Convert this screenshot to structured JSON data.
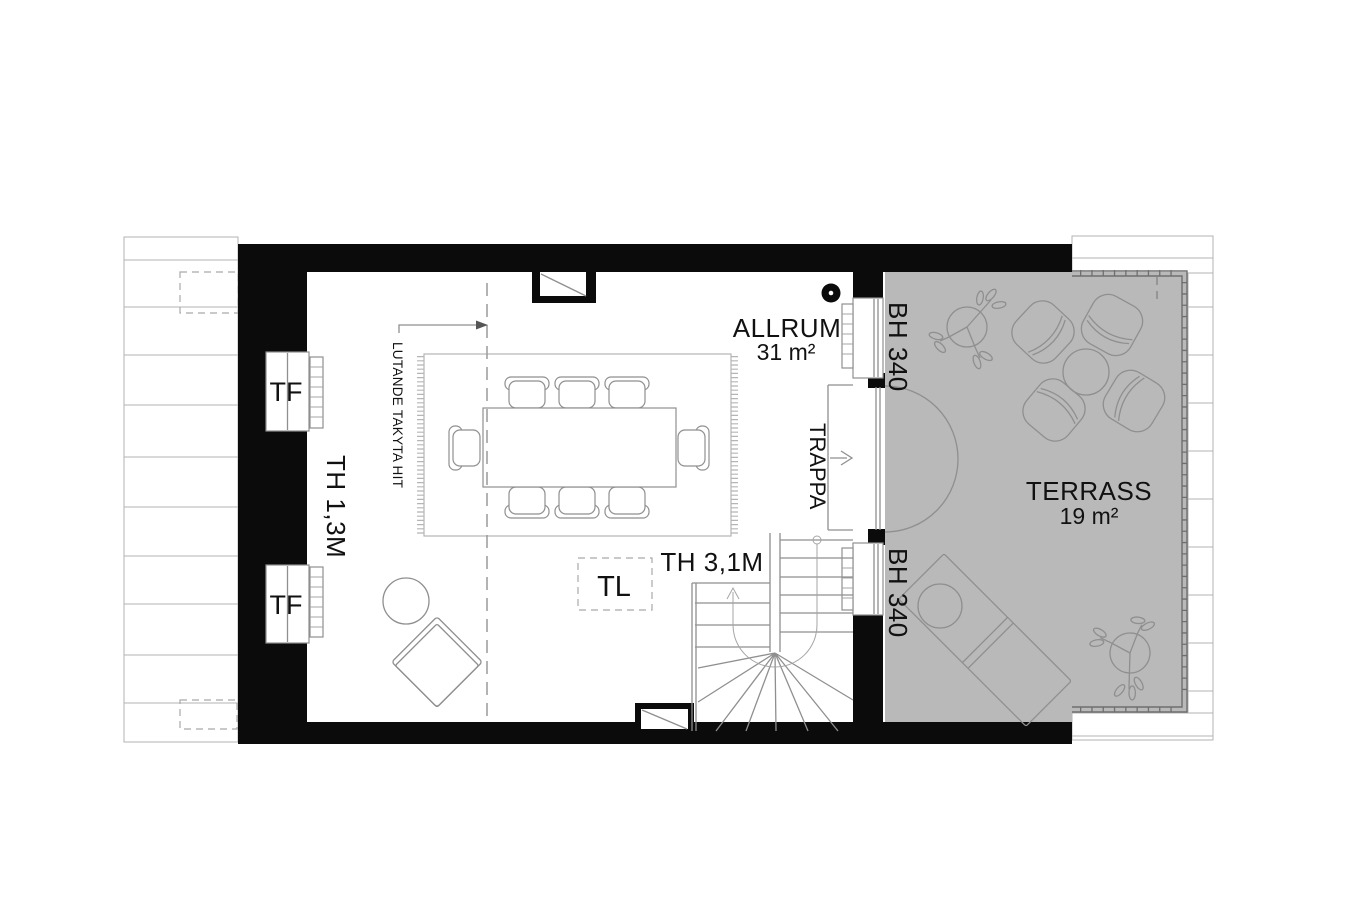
{
  "rooms": {
    "allrum": {
      "name": "ALLRUM",
      "area": "31 m²"
    },
    "terrass": {
      "name": "TERRASS",
      "area": "19 m²"
    }
  },
  "annotations": {
    "stair": "TRAPPA",
    "skylight": "TL",
    "ceiling_height_stair": "TH 3,1M",
    "ceiling_height_left": "TH 1,3M",
    "sloped_ceiling_note": "LUTANDE TAKYTA HIT",
    "sill_height_top": "BH 340",
    "sill_height_bottom": "BH 340",
    "window_top": "TF",
    "window_bottom": "TF"
  },
  "colors": {
    "wall": "#0b0b0b",
    "terrace_fill": "#b9b9b9",
    "drawing_line": "#8f8f8f",
    "roof_line": "#b3b3b3",
    "text": "#111111"
  }
}
